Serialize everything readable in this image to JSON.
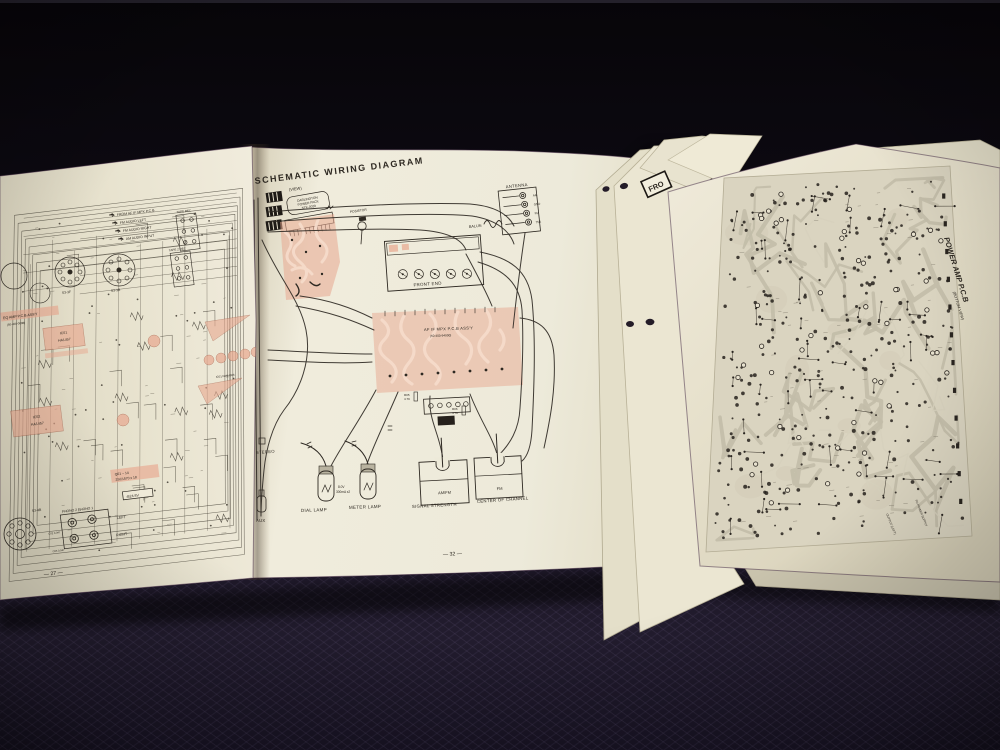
{
  "colors": {
    "fabric": "#171320",
    "paper": "#ece7d5",
    "paper_dark": "#d9d3bc",
    "ink": "#2e2922",
    "pink": "#e8a88f",
    "trace": "#c2bca8"
  },
  "booklet": {
    "title": "SCHEMATIC WIRING DIAGRAM",
    "title_note": "(VIEW)",
    "left_page_number": "— 27 —",
    "right_page_number": "— 32 —"
  },
  "left": {
    "input_labels": [
      "FROM AF IF MPX P.C.B",
      "FM AUDIO LEFT",
      "FM AUDIO RIGHT",
      "AM AUDIO INPUT"
    ],
    "tape_rec": "TAPE REC",
    "tape2_rec": "TAPE 2 REC",
    "s3_3f": "S3-3F",
    "s3_3b": "S3-3B",
    "eq_line1": "EQ AMP P.C.B ASS'Y",
    "eq_line2": "(50-400-0098)",
    "ic01": "IC01",
    "ic02": "IC02",
    "ha1457": "HA1457",
    "njm": "IC01 NJM4558",
    "q_line1": "Q01 ~ 14",
    "q_line2": "2SC1570 x 18",
    "b24": "-B24 8V",
    "c02": "C02 0.047",
    "c03": "C03 0.047",
    "s3_4b": "S3-4B",
    "phono": "PHONO 2 PHONO 1",
    "left": "LEFT",
    "right": "RIGHT"
  },
  "mid": {
    "darlington": [
      "DARLINGTON",
      "POWER PACK",
      "STK-0029"
    ],
    "posistor": "POSISTOR",
    "antenna": "ANTENNA",
    "ant_terms": [
      "AM",
      "GND",
      "FM",
      "75Ω"
    ],
    "balun": "BALUN",
    "front_end": "FRONT END",
    "mpx1": "AF IF MPX P.C.B ASS'Y",
    "mpx2": "(50-400-94900)",
    "r05": [
      "R05",
      "4.7K"
    ],
    "r06": [
      "R06",
      "4.7K"
    ],
    "stereo": "STEREO",
    "aux": "AUX",
    "dial": "DIAL LAMP",
    "meter": "METER LAMP",
    "spec": [
      "8.0V",
      "300mA x2"
    ],
    "m1_face": "AM/FM",
    "m1_label": "SIGNAL STRENGTH",
    "m2_face": "FM",
    "m2_label": "CENTER OF CHANNEL"
  },
  "right": {
    "title": "POWER AMP P.C.B",
    "subtitle": "(BOTTOM VIEW)",
    "out_label": "OUTPUT (LEFT)",
    "pwr_label": "TO POWER SUPPLY"
  },
  "stack": {
    "label": "FRO"
  }
}
